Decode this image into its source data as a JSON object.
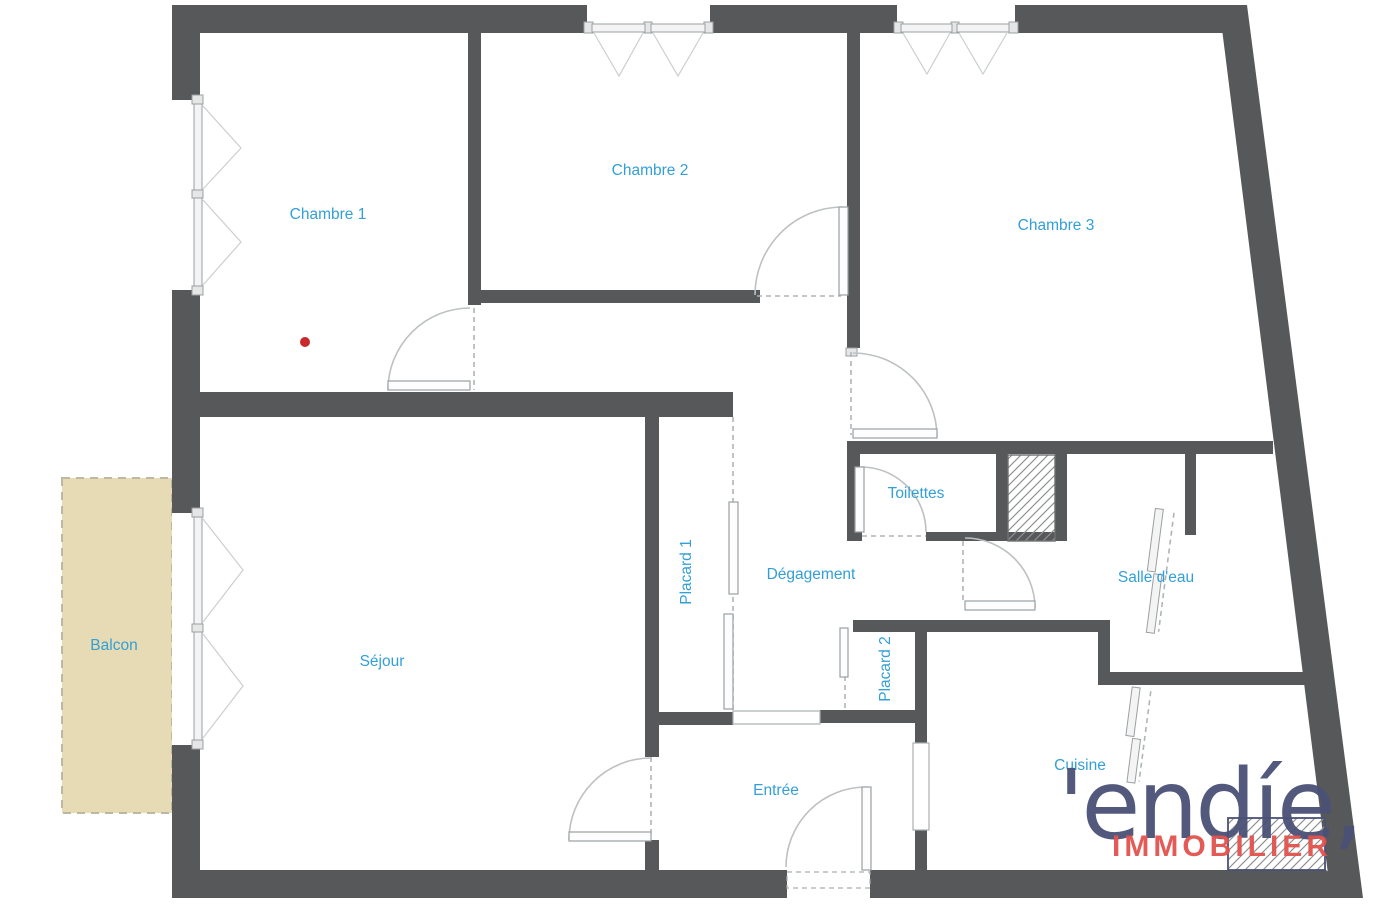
{
  "page": {
    "title": "Plan d'appartement",
    "background": "#ffffff"
  },
  "rooms": {
    "chambre1": {
      "label": "Chambre 1"
    },
    "chambre2": {
      "label": "Chambre 2"
    },
    "chambre3": {
      "label": "Chambre 3"
    },
    "sejour": {
      "label": "Séjour"
    },
    "balcon": {
      "label": "Balcon"
    },
    "degagement": {
      "label": "Dégagement"
    },
    "placard1": {
      "label": "Placard 1"
    },
    "placard2": {
      "label": "Placard 2"
    },
    "toilettes": {
      "label": "Toilettes"
    },
    "salledeau": {
      "label": "Salle d'eau"
    },
    "entree": {
      "label": "Entrée"
    },
    "cuisine": {
      "label": "Cuisine"
    }
  },
  "logo": {
    "brand": "'endíe,",
    "tagline": "IMMOBILIER"
  },
  "colors": {
    "wall": "#56585a",
    "label_blue": "#339fd6",
    "balcony_fill": "#e6dbb4",
    "logo_navy": "#4a5176",
    "logo_red": "#e2534e",
    "marker_red": "#c8292c"
  }
}
